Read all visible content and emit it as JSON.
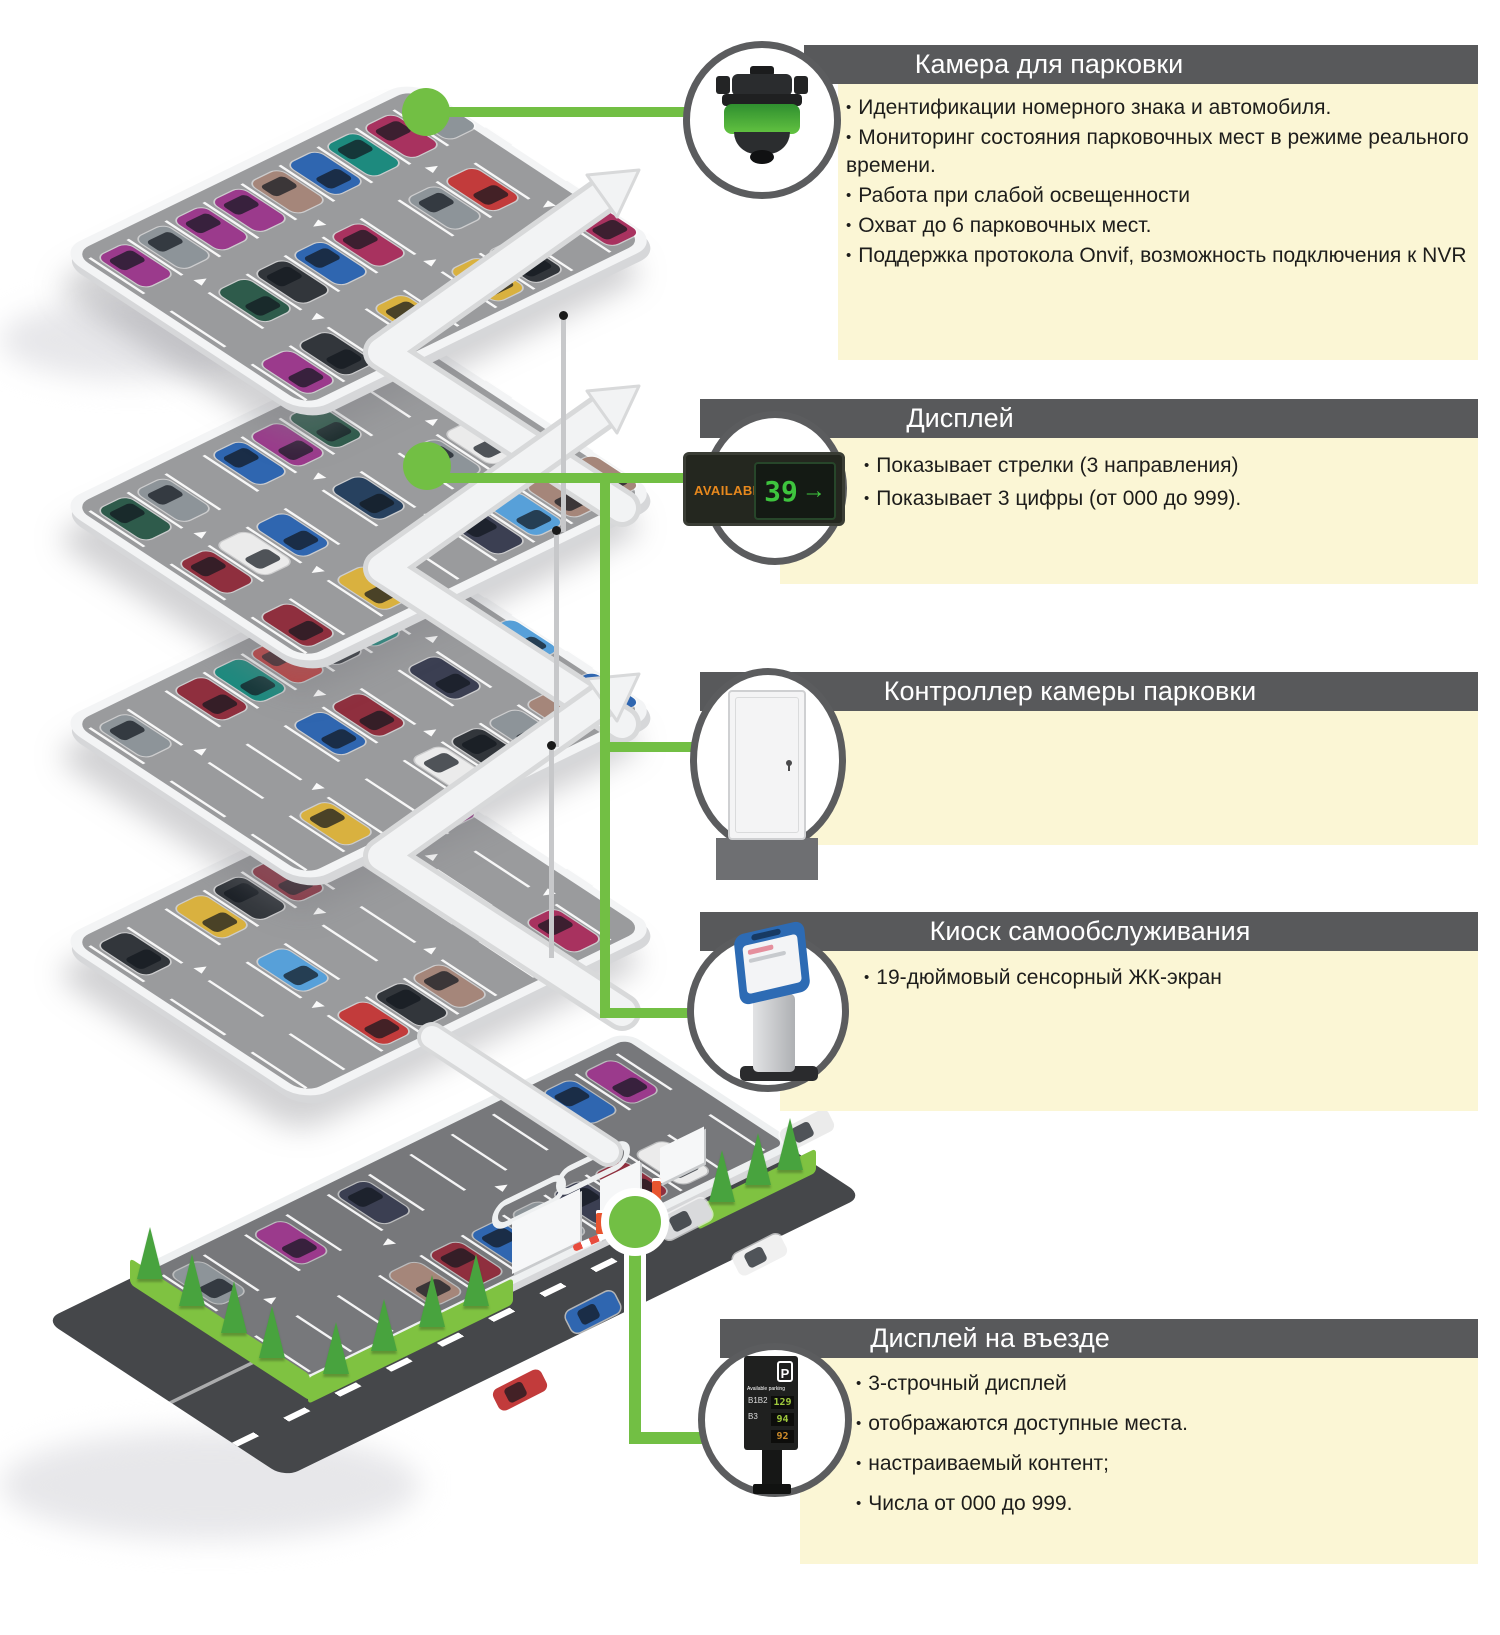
{
  "palette": {
    "accent_green": "#72bf44",
    "bar_bg": "#58595b",
    "panel_bg": "#fbf6d5",
    "circle_ring": "#5b5c5e",
    "deck_surface": "#9a9b9d",
    "lot_surface": "#77787b",
    "road_surface": "#45474a",
    "grass": "#7fc241"
  },
  "sections": [
    {
      "id": "camera",
      "title": "Камера для парковки",
      "bullets": [
        "Идентификации номерного знака и автомобиля.",
        "Мониторинг состояния парковочных мест в режиме реального времени.",
        "Работа при слабой освещенности",
        "Охват до 6 парковочных мест.",
        "Поддержка протокола Onvif, возможность подключения к NVR"
      ]
    },
    {
      "id": "display",
      "title": "Дисплей",
      "bullets": [
        "Показывает стрелки (3 направления)",
        "Показывает 3 цифры (от 000 до 999)."
      ]
    },
    {
      "id": "controller",
      "title": "Контроллер камеры парковки",
      "bullets": []
    },
    {
      "id": "kiosk",
      "title": "Киоск самообслуживания",
      "bullets": [
        "19-дюймовый сенсорный ЖК-экран"
      ]
    },
    {
      "id": "entrance-display",
      "title": "Дисплей на въезде",
      "bullets": [
        "3-строчный дисплей",
        "отображаются доступные места.",
        "настраиваемый контент;",
        "Числа от 000 до 999."
      ]
    }
  ],
  "display_sign": {
    "label": "AVAILABLE",
    "value": "39",
    "arrow": "→"
  },
  "entrance_sign": {
    "logo": "P",
    "brand": "Available parking",
    "zones": [
      "B1B2",
      "B3"
    ],
    "values": [
      {
        "num": "129",
        "color": "green"
      },
      {
        "num": "94",
        "color": "green"
      },
      {
        "num": "92",
        "color": "amber"
      }
    ]
  },
  "illustration": {
    "deck_cars": [
      24,
      21,
      23,
      21
    ],
    "ground_cars": 15,
    "car_colors": [
      "#c23b3b",
      "#8f2f3e",
      "#2f66b0",
      "#57a0d9",
      "#27415f",
      "#1d8a7e",
      "#d9b13f",
      "#9b3a8c",
      "#a8325f",
      "#2e5b4b",
      "#a5867a",
      "#32363b",
      "#8d9499",
      "#ebebeb",
      "#3b3f52"
    ]
  }
}
